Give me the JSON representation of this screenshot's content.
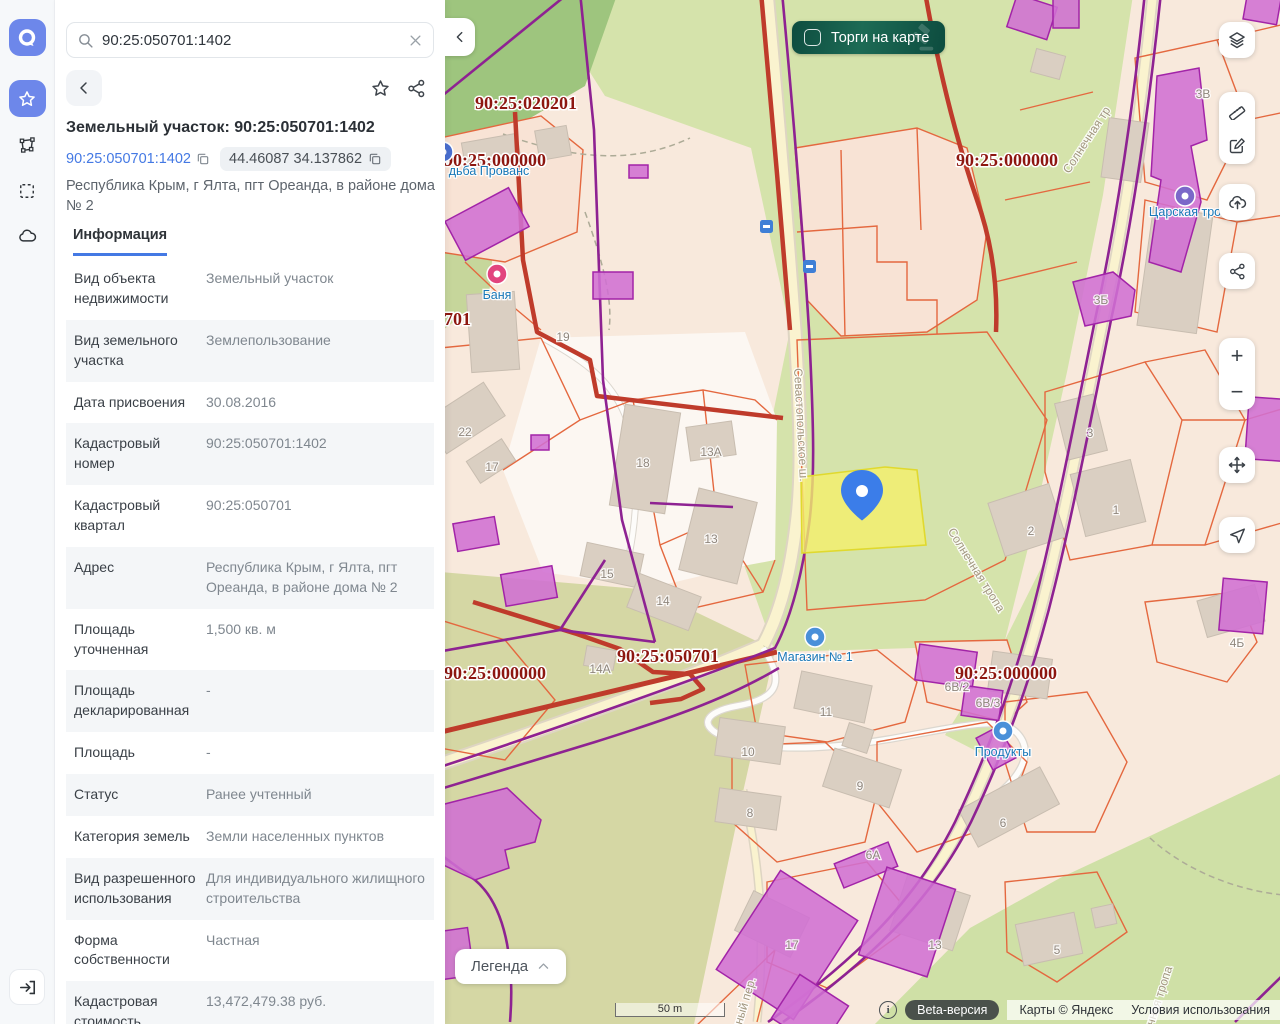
{
  "panel": {
    "search": {
      "value": "90:25:050701:1402"
    },
    "title": "Земельный участок: 90:25:050701:1402",
    "cadastral_link": "90:25:050701:1402",
    "coordinates": "44.46087 34.137862",
    "address": "Республика Крым, г Ялта, пгт Ореанда, в районе дома № 2",
    "tab_label": "Информация",
    "info_rows": [
      {
        "label": "Вид объекта недвижимости",
        "value": "Земельный участок"
      },
      {
        "label": "Вид земельного участка",
        "value": "Землепользование"
      },
      {
        "label": "Дата присвоения",
        "value": "30.08.2016"
      },
      {
        "label": "Кадастровый номер",
        "value": "90:25:050701:1402"
      },
      {
        "label": "Кадастровый квартал",
        "value": "90:25:050701"
      },
      {
        "label": "Адрес",
        "value": "Республика Крым, г Ялта, пгт Ореанда, в районе дома № 2"
      },
      {
        "label": "Площадь уточненная",
        "value": "1,500 кв. м"
      },
      {
        "label": "Площадь декларированная",
        "value": "-"
      },
      {
        "label": "Площадь",
        "value": "-"
      },
      {
        "label": "Статус",
        "value": "Ранее учтенный"
      },
      {
        "label": "Категория земель",
        "value": "Земли населенных пунктов"
      },
      {
        "label": "Вид разрешенного использования",
        "value": "Для индивидуального жилищного строительства"
      },
      {
        "label": "Форма собственности",
        "value": "Частная"
      },
      {
        "label": "Кадастровая стоимость",
        "value": "13,472,479.38 руб."
      }
    ]
  },
  "map": {
    "toggle_label": "Торги на карте",
    "legend_label": "Легенда",
    "scale_label": "50 m",
    "zoom_in_label": "+",
    "zoom_out_label": "−",
    "beta_label": "Beta-версия",
    "attribution": "Карты © Яндекс",
    "terms": "Условия использования",
    "info_glyph": "i",
    "quarter_labels": [
      {
        "text": "90:25:020201",
        "x": 81,
        "y": 109
      },
      {
        "text": "90:25:000000",
        "x": 50,
        "y": 166
      },
      {
        "text": "90:25:000000",
        "x": 562,
        "y": 166
      },
      {
        "text": "90:25:050701",
        "x": -25,
        "y": 325
      },
      {
        "text": "90:25:050701",
        "x": 223,
        "y": 662
      },
      {
        "text": "90:25:000000",
        "x": 50,
        "y": 679
      },
      {
        "text": "90:25:000000",
        "x": 561,
        "y": 679
      }
    ],
    "house_numbers": [
      {
        "text": "19",
        "x": 118,
        "y": 341
      },
      {
        "text": "22",
        "x": 20,
        "y": 436
      },
      {
        "text": "17",
        "x": 47,
        "y": 471
      },
      {
        "text": "18",
        "x": 198,
        "y": 467
      },
      {
        "text": "13А",
        "x": 266,
        "y": 456
      },
      {
        "text": "13",
        "x": 266,
        "y": 543
      },
      {
        "text": "15",
        "x": 162,
        "y": 578
      },
      {
        "text": "14",
        "x": 218,
        "y": 605
      },
      {
        "text": "14А",
        "x": 155,
        "y": 673
      },
      {
        "text": "11",
        "x": 381,
        "y": 716
      },
      {
        "text": "10",
        "x": 303,
        "y": 756
      },
      {
        "text": "9",
        "x": 415,
        "y": 790
      },
      {
        "text": "8",
        "x": 305,
        "y": 817
      },
      {
        "text": "6",
        "x": 558,
        "y": 827
      },
      {
        "text": "6А",
        "x": 428,
        "y": 859
      },
      {
        "text": "6В/2",
        "x": 512,
        "y": 691
      },
      {
        "text": "6В/3",
        "x": 543,
        "y": 707
      },
      {
        "text": "3",
        "x": 645,
        "y": 437
      },
      {
        "text": "2",
        "x": 586,
        "y": 535
      },
      {
        "text": "1",
        "x": 671,
        "y": 514
      },
      {
        "text": "4Б",
        "x": 792,
        "y": 647
      },
      {
        "text": "17",
        "x": 347,
        "y": 949
      },
      {
        "text": "13",
        "x": 490,
        "y": 949
      },
      {
        "text": "5",
        "x": 612,
        "y": 954
      },
      {
        "text": "3В",
        "x": 758,
        "y": 98
      },
      {
        "text": "3Б",
        "x": 656,
        "y": 304
      }
    ],
    "street_labels": [
      {
        "text": "Севастопольское ш.",
        "x": 352,
        "y": 425,
        "rotate": 87
      },
      {
        "text": "Солнечная тропа",
        "x": 528,
        "y": 572,
        "rotate": 58
      },
      {
        "text": "Солнечная тр",
        "x": 645,
        "y": 142,
        "rotate": -57
      },
      {
        "text": "нечная тропа",
        "x": 716,
        "y": 1003,
        "rotate": -72
      },
      {
        "text": "ечный пер.",
        "x": 302,
        "y": 1008,
        "rotate": -73
      }
    ],
    "poi_labels": [
      {
        "text": "дьба Прованс",
        "x": 44,
        "y": 175,
        "icon_x": -2,
        "icon_y": 152,
        "color": "#4a6fd0"
      },
      {
        "text": "Баня",
        "x": 52,
        "y": 299,
        "icon_x": 52,
        "icon_y": 274,
        "color": "#e2447e"
      },
      {
        "text": "Магазин № 1",
        "x": 370,
        "y": 661,
        "icon_x": 370,
        "icon_y": 637,
        "color": "#4a90d9"
      },
      {
        "text": "Продукты",
        "x": 558,
        "y": 756,
        "icon_x": 558,
        "icon_y": 731,
        "color": "#4a90d9"
      },
      {
        "text": "Царская тро",
        "x": 740,
        "y": 216,
        "icon_x": 740,
        "icon_y": 196,
        "color": "#7b68c9"
      }
    ]
  },
  "colors": {
    "accent": "#6d87ea",
    "link": "#4479e4",
    "quarter": "#8d1710",
    "pill1": "#1d6b55",
    "pill2": "#0d4c3f",
    "selected_parcel": "#f4ef6b",
    "pin": "#3b7de9",
    "building_magenta": "#d06fd3",
    "parcel_line": "#e4683f",
    "zone_line": "#8e2292",
    "boundary_red": "#bf3b2b"
  }
}
